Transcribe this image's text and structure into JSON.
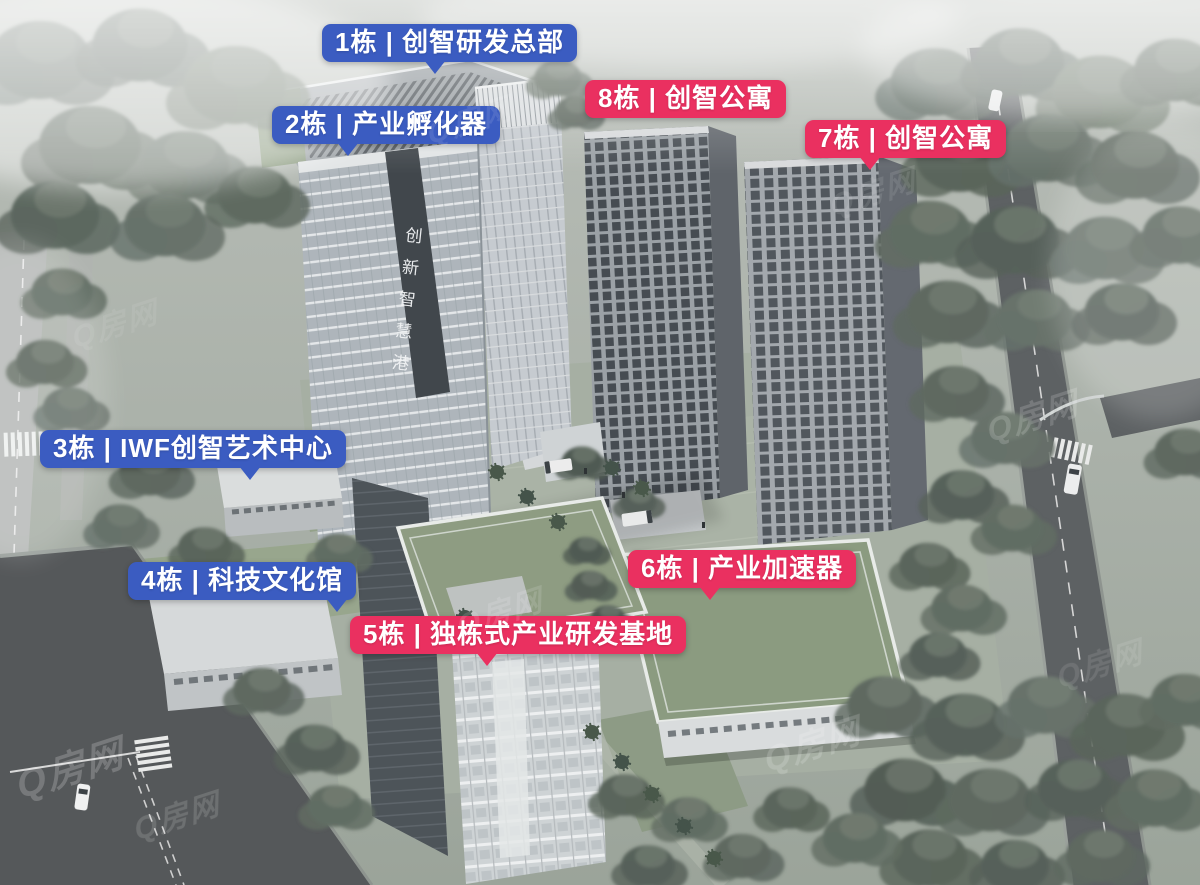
{
  "building_labels": [
    {
      "id": "b1",
      "text": "1栋 | 创智研发总部",
      "style": "blue"
    },
    {
      "id": "b2",
      "text": "2栋 | 产业孵化器",
      "style": "blue"
    },
    {
      "id": "b8",
      "text": "8栋 | 创智公寓",
      "style": "red"
    },
    {
      "id": "b7",
      "text": "7栋 | 创智公寓",
      "style": "red"
    },
    {
      "id": "b3",
      "text": "3栋 | IWF创智艺术中心",
      "style": "blue"
    },
    {
      "id": "b4",
      "text": "4栋 | 科技文化馆",
      "style": "blue"
    },
    {
      "id": "b5",
      "text": "5栋 | 独栋式产业研发基地",
      "style": "red"
    },
    {
      "id": "b6",
      "text": "6栋 | 产业加速器",
      "style": "red"
    }
  ],
  "facade_sign": {
    "text": "创新智慧港"
  },
  "watermark": {
    "text": "Q房网"
  },
  "colors": {
    "label_blue": "#3b5cc1",
    "label_red": "#ea3060",
    "sign_text": "#ffffff",
    "green_roof": "#8d9c82",
    "tree": "#67726a",
    "road": "#595d5e"
  }
}
